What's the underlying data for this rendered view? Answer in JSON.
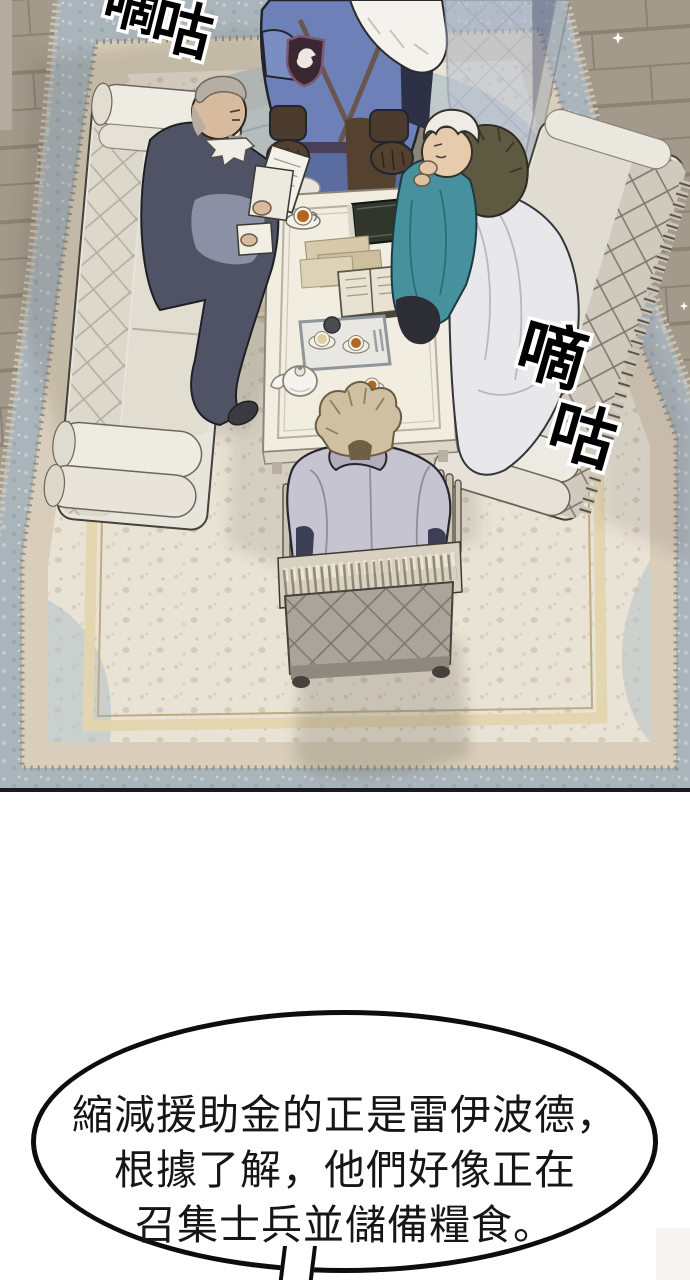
{
  "panel": {
    "sfx_top_left": {
      "char1": "嘀",
      "char2": "咕"
    },
    "sfx_right": {
      "char1": "嘀",
      "char2": "咕"
    }
  },
  "speech_bubble": {
    "line1": "縮減援助金的正是雷伊波德，",
    "line2": "根據了解，他們好像正在",
    "line3": "召集士兵並儲備糧食。"
  },
  "colors": {
    "floor": "#a49a8c",
    "carpet_border_blue": "#aab5bb",
    "carpet_band_tan": "#d8cebb",
    "carpet_field": "#e9e3d5",
    "carpet_medallion": "#b6c3c8",
    "sofa_upholstery": "#e7e4dc",
    "knight_armor_blue": "#6d81b8",
    "knight_fur_white": "#f4f2ec",
    "emblem_maroon": "#3a2733",
    "old_man_robe_slate": "#4f5365",
    "advisor_robe_teal": "#47919f",
    "fur_collar_olive": "#5e5a42",
    "blanket_white": "#e8e7ea",
    "blonde_hair": "#cfc0a2",
    "jacket_lilac_gray": "#c6c4d0",
    "chair_gray": "#a9a59b",
    "table_cream": "#f1ede0",
    "tea_amber": "#b5651d",
    "ghost_blue_gray": "#b9c0d2",
    "sfx_fill": "#000000",
    "bubble_border": "#0d0d0d",
    "bubble_fill": "#ffffff",
    "gap_background": "#ffffff"
  }
}
